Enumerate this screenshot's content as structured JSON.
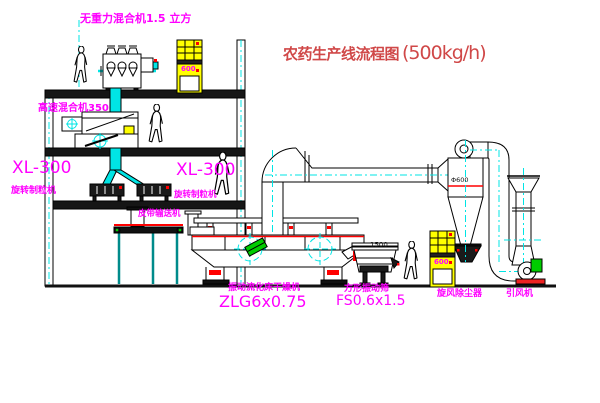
{
  "diagram": {
    "title": {
      "zh": "农药生产线流程图",
      "capacity": "(500kg/h)"
    },
    "labels": {
      "gravity_mixer": "无重力混合机1.5 立方",
      "high_speed_mixer": "高速混合机350",
      "granulator_left": {
        "model": "XL-300",
        "name": "旋转制粒机"
      },
      "granulator_right": {
        "model": "XL-300",
        "name": "旋转制粒机"
      },
      "belt_conveyor": "皮带输送机",
      "fluid_bed_dryer": {
        "name": "振动流化床干燥机",
        "model": "ZLG6x0.75"
      },
      "square_sieve": {
        "name": "方形振动筛",
        "model": "FS0.6x1.5"
      },
      "cyclone": "旋风除尘器",
      "induced_draft_fan": "引风机",
      "sieve_dimension": "1500",
      "cyclone_dimension": "Φ600",
      "cabinet_marking_top": "600",
      "cabinet_marking_right": "600"
    },
    "colors": {
      "label_magenta": "#ff00ff",
      "title_red": "#d04848",
      "pipe_cyan": "#00e5e5",
      "cabinet_yellow": "#ffff00",
      "accent_red": "#ff0000",
      "accent_green": "#00cc00",
      "line_black": "#000000",
      "background": "#ffffff"
    }
  }
}
